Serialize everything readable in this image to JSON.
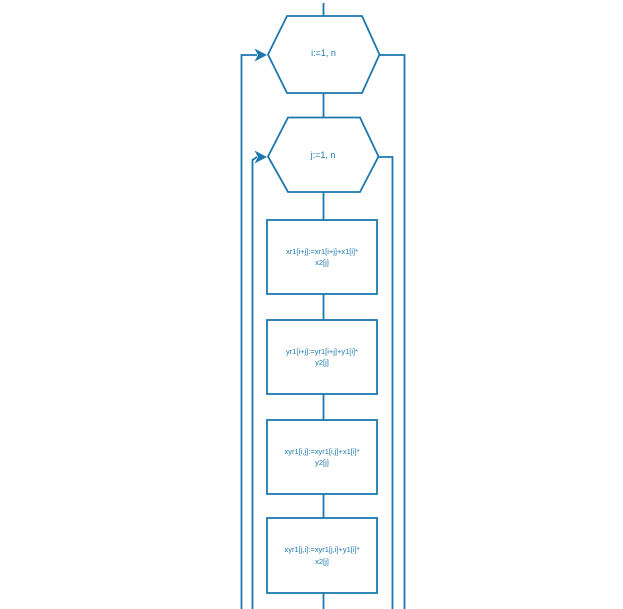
{
  "flowchart": {
    "stroke_color": "#1b78ae",
    "text_color": "#1b78ae",
    "outer_loop": {
      "shape": "hexagon",
      "label": "i:=1, n"
    },
    "inner_loop": {
      "shape": "hexagon",
      "label": "j:=1, n"
    },
    "blocks": [
      {
        "line1": "xr1[i+j]:=xr1[i+j]+x1[i]*",
        "line2": "x2[j]"
      },
      {
        "line1": "yr1[i+j]:=yr1[i+j]+y1[i]*",
        "line2": "y2[j]"
      },
      {
        "line1": "xyr1[i,j]:=xyr1[i,j]+x1[i]*",
        "line2": "y2[j]"
      },
      {
        "line1": "xyr1[j,i]:=xyr1[j,i]+y1[i]*",
        "line2": "x2[j]"
      }
    ]
  }
}
